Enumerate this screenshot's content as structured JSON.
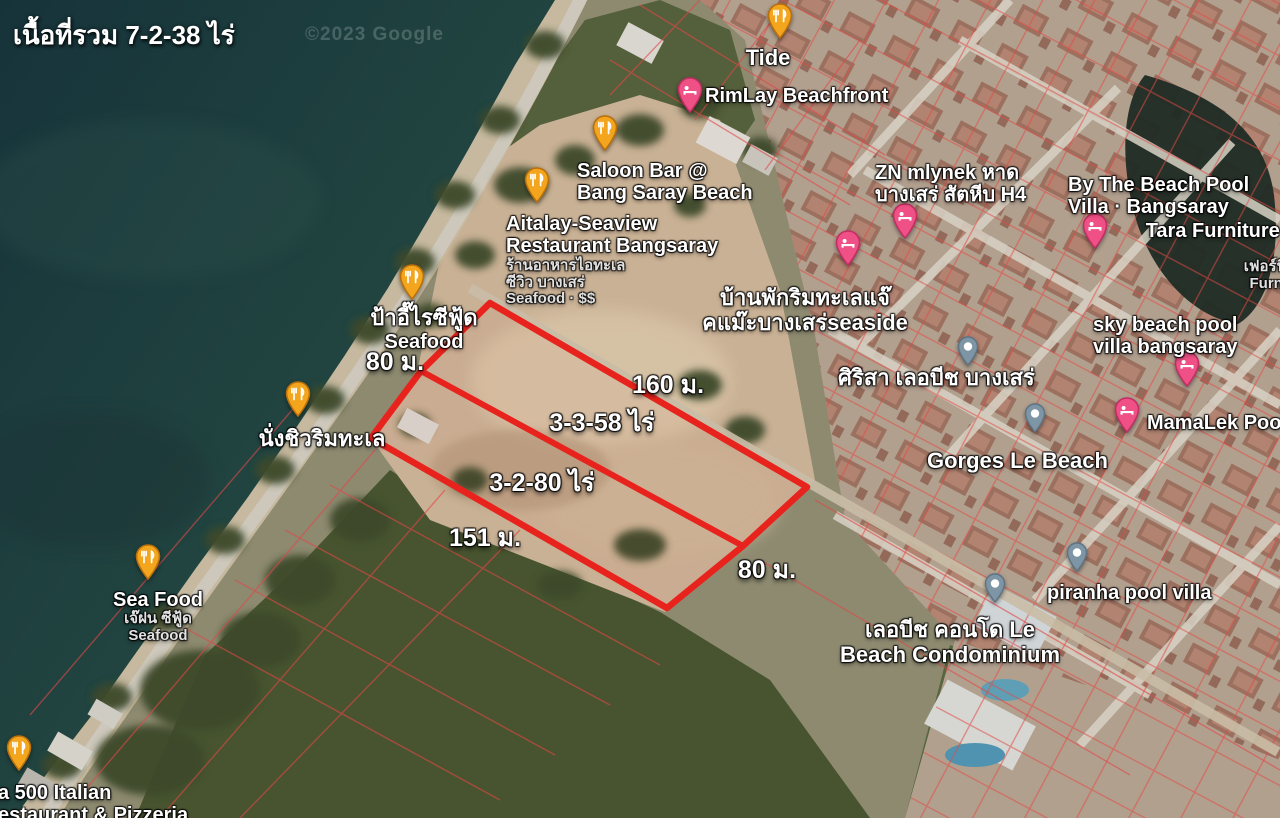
{
  "header": {
    "total_area_label": "เนื้อที่รวม 7-2-38 ไร่",
    "watermark": "©2023 Google"
  },
  "colors": {
    "plot_outline": "#e8231d",
    "restaurant_pin": "#F2A51D",
    "restaurant_pin_border": "#B96F0B",
    "hotel_pin": "#EF5086",
    "hotel_pin_border": "#C02F64",
    "place_pin": "#7E95A5",
    "place_pin_border": "#5E7384"
  },
  "plot": {
    "outer_points": "490,303 807,487 743,546 667,608 371,438 421,371",
    "divider": {
      "x1": 421,
      "y1": 371,
      "x2": 743,
      "y2": 546
    },
    "labels": [
      {
        "name": "dim-left-80m",
        "text": "80 ม.",
        "x": 395,
        "y": 342
      },
      {
        "name": "dim-top-160m",
        "text": "160 ม.",
        "x": 668,
        "y": 365
      },
      {
        "name": "area-parcel-1",
        "text": "3-3-58 ไร่",
        "x": 602,
        "y": 403
      },
      {
        "name": "area-parcel-2",
        "text": "3-2-80 ไร่",
        "x": 542,
        "y": 463
      },
      {
        "name": "dim-bottom-151m",
        "text": "151 ม.",
        "x": 485,
        "y": 518
      },
      {
        "name": "dim-right-80m",
        "text": "80 ม.",
        "x": 767,
        "y": 550
      }
    ]
  },
  "places": [
    {
      "id": "tide",
      "pin": {
        "type": "restaurant",
        "x": 780,
        "y": 44
      },
      "label": {
        "x": 768,
        "y": 46,
        "align": "center",
        "lines": [
          {
            "t": "Tide",
            "style": "primary-lg"
          }
        ]
      }
    },
    {
      "id": "rimlay-beachfront",
      "pin": {
        "type": "hotel",
        "x": 690,
        "y": 118
      },
      "label": {
        "x": 705,
        "y": 85,
        "align": "left",
        "lines": [
          {
            "t": "RimLay Beachfront",
            "style": "primary"
          }
        ]
      }
    },
    {
      "id": "saloon-bar",
      "pin": {
        "type": "restaurant",
        "x": 605,
        "y": 156
      },
      "label": {
        "x": 577,
        "y": 160,
        "align": "left",
        "lines": [
          {
            "t": "Saloon Bar @",
            "style": "primary"
          },
          {
            "t": "Bang Saray Beach",
            "style": "primary"
          }
        ]
      }
    },
    {
      "id": "aitalay-seaview",
      "pin": {
        "type": "restaurant",
        "x": 537,
        "y": 208
      },
      "label": {
        "x": 506,
        "y": 213,
        "align": "left",
        "lines": [
          {
            "t": "Aitalay-Seaview",
            "style": "primary"
          },
          {
            "t": "Restaurant Bangsaray",
            "style": "primary"
          },
          {
            "t": "ร้านอาหารไอทะเล",
            "style": "secondary"
          },
          {
            "t": "ซีวิว บางเสร่",
            "style": "secondary"
          },
          {
            "t": "Seafood · $$",
            "style": "secondary"
          }
        ]
      }
    },
    {
      "id": "pa-ee-rai-seafood",
      "pin": {
        "type": "restaurant",
        "x": 412,
        "y": 305
      },
      "label": {
        "x": 424,
        "y": 306,
        "align": "center",
        "lines": [
          {
            "t": "ป้าอี๊ไรซีฟู้ด",
            "style": "primary-lg"
          },
          {
            "t": "Seafood",
            "style": "primary"
          }
        ]
      }
    },
    {
      "id": "nang-chill-rim-talay",
      "pin": {
        "type": "restaurant",
        "x": 298,
        "y": 422
      },
      "label": {
        "x": 322,
        "y": 427,
        "align": "center",
        "lines": [
          {
            "t": "นั่งชิวริมทะเล",
            "style": "primary-lg"
          }
        ]
      }
    },
    {
      "id": "sea-food-je-fon",
      "pin": {
        "type": "restaurant",
        "x": 148,
        "y": 585
      },
      "label": {
        "x": 158,
        "y": 589,
        "align": "center",
        "lines": [
          {
            "t": "Sea Food",
            "style": "primary"
          },
          {
            "t": "เจ๊ฝน ซีฟู้ด",
            "style": "secondary"
          },
          {
            "t": "Seafood",
            "style": "secondary"
          }
        ]
      }
    },
    {
      "id": "italian-500",
      "pin": {
        "type": "restaurant",
        "x": 19,
        "y": 776
      },
      "label": {
        "x": -2,
        "y": 782,
        "align": "left",
        "lines": [
          {
            "t": "a 500 Italian",
            "style": "primary"
          },
          {
            "t": "estaurant & Pizzeria",
            "style": "primary"
          }
        ]
      }
    },
    {
      "id": "zn-mlynek",
      "pin": {
        "type": "hotel",
        "x": 905,
        "y": 244
      },
      "label": {
        "x": 875,
        "y": 162,
        "align": "left",
        "lines": [
          {
            "t": "ZN mlynek หาด",
            "style": "primary"
          },
          {
            "t": "บางเสร่ สัตหีบ H4",
            "style": "primary"
          }
        ]
      }
    },
    {
      "id": "hotel-pin-2",
      "pin": {
        "type": "hotel",
        "x": 848,
        "y": 271
      }
    },
    {
      "id": "by-the-beach-pool-villa",
      "pin": {
        "type": "hotel",
        "x": 1095,
        "y": 254
      },
      "label": {
        "x": 1068,
        "y": 174,
        "align": "left",
        "lines": [
          {
            "t": "By The Beach Pool",
            "style": "primary"
          },
          {
            "t": "Villa · Bangsaray",
            "style": "primary"
          }
        ]
      }
    },
    {
      "id": "tara-furniture",
      "label": {
        "x": 1292,
        "y": 220,
        "align": "right",
        "lines": [
          {
            "t": "Tara Furniture (",
            "style": "primary"
          },
          {
            "t": "บ",
            "style": "secondary"
          },
          {
            "t": "เฟอร์นิเ",
            "style": "secondary"
          },
          {
            "t": "Furnit",
            "style": "secondary"
          }
        ]
      }
    },
    {
      "id": "ban-pak-rim-talay-seaside",
      "label": {
        "x": 805,
        "y": 286,
        "align": "center",
        "lines": [
          {
            "t": "บ้านพักริมทะเลแจ๊",
            "style": "primary-lg"
          },
          {
            "t": "คแม๊ะบางเสร่seaside",
            "style": "primary-lg"
          }
        ]
      }
    },
    {
      "id": "sky-beach-pool-villa",
      "pin": {
        "type": "hotel",
        "x": 1187,
        "y": 392
      },
      "label": {
        "x": 1093,
        "y": 314,
        "align": "left",
        "lines": [
          {
            "t": "sky beach pool",
            "style": "primary"
          },
          {
            "t": "villa bangsaray",
            "style": "primary"
          }
        ]
      }
    },
    {
      "id": "sirisa-le-beach",
      "pin": {
        "type": "place",
        "x": 968,
        "y": 371
      },
      "label": {
        "x": 838,
        "y": 366,
        "align": "left",
        "lines": [
          {
            "t": "ศิริสา เลอบีช บางเสร่",
            "style": "primary-lg"
          }
        ]
      }
    },
    {
      "id": "mamalek-pool-villa",
      "pin": {
        "type": "hotel",
        "x": 1127,
        "y": 438
      },
      "label": {
        "x": 1147,
        "y": 412,
        "align": "left",
        "lines": [
          {
            "t": "MamaLek Pool V",
            "style": "primary"
          }
        ]
      }
    },
    {
      "id": "gorges-le-beach",
      "pin": {
        "type": "place",
        "x": 1035,
        "y": 438
      },
      "label": {
        "x": 927,
        "y": 449,
        "align": "left",
        "lines": [
          {
            "t": "Gorges Le Beach",
            "style": "primary-lg"
          }
        ]
      }
    },
    {
      "id": "piranha-pool-villa",
      "pin": {
        "type": "place",
        "x": 1077,
        "y": 577
      },
      "label": {
        "x": 1047,
        "y": 582,
        "align": "left",
        "lines": [
          {
            "t": "piranha pool villa",
            "style": "primary"
          }
        ]
      }
    },
    {
      "id": "le-beach-condominium",
      "pin": {
        "type": "place",
        "x": 995,
        "y": 608
      },
      "label": {
        "x": 950,
        "y": 618,
        "align": "center",
        "lines": [
          {
            "t": "เลอบีช คอนโด Le",
            "style": "primary-lg"
          },
          {
            "t": "Beach Condominium",
            "style": "primary-lg"
          }
        ]
      }
    }
  ]
}
